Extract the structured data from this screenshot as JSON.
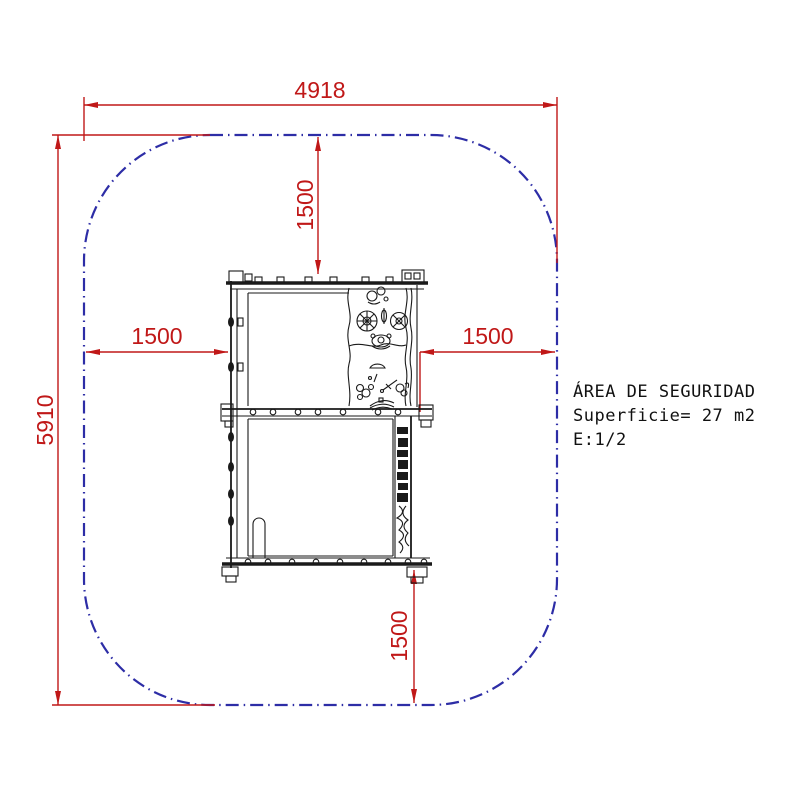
{
  "drawing": {
    "kind": "playground safety area plan",
    "info_panel": {
      "line1": "ÁREA DE SEGURIDAD",
      "line2": "Superficie= 27 m2",
      "line3": "E:1/2"
    },
    "dimensions": {
      "total_width": "4918",
      "total_height": "5910",
      "clearance_top": "1500",
      "clearance_left": "1500",
      "clearance_right": "1500",
      "clearance_bottom": "1500"
    },
    "colors": {
      "dimension_red": "#c01818",
      "boundary_blue": "#2d2da6",
      "drawing_black": "#1a1a1a",
      "background": "#ffffff"
    }
  }
}
